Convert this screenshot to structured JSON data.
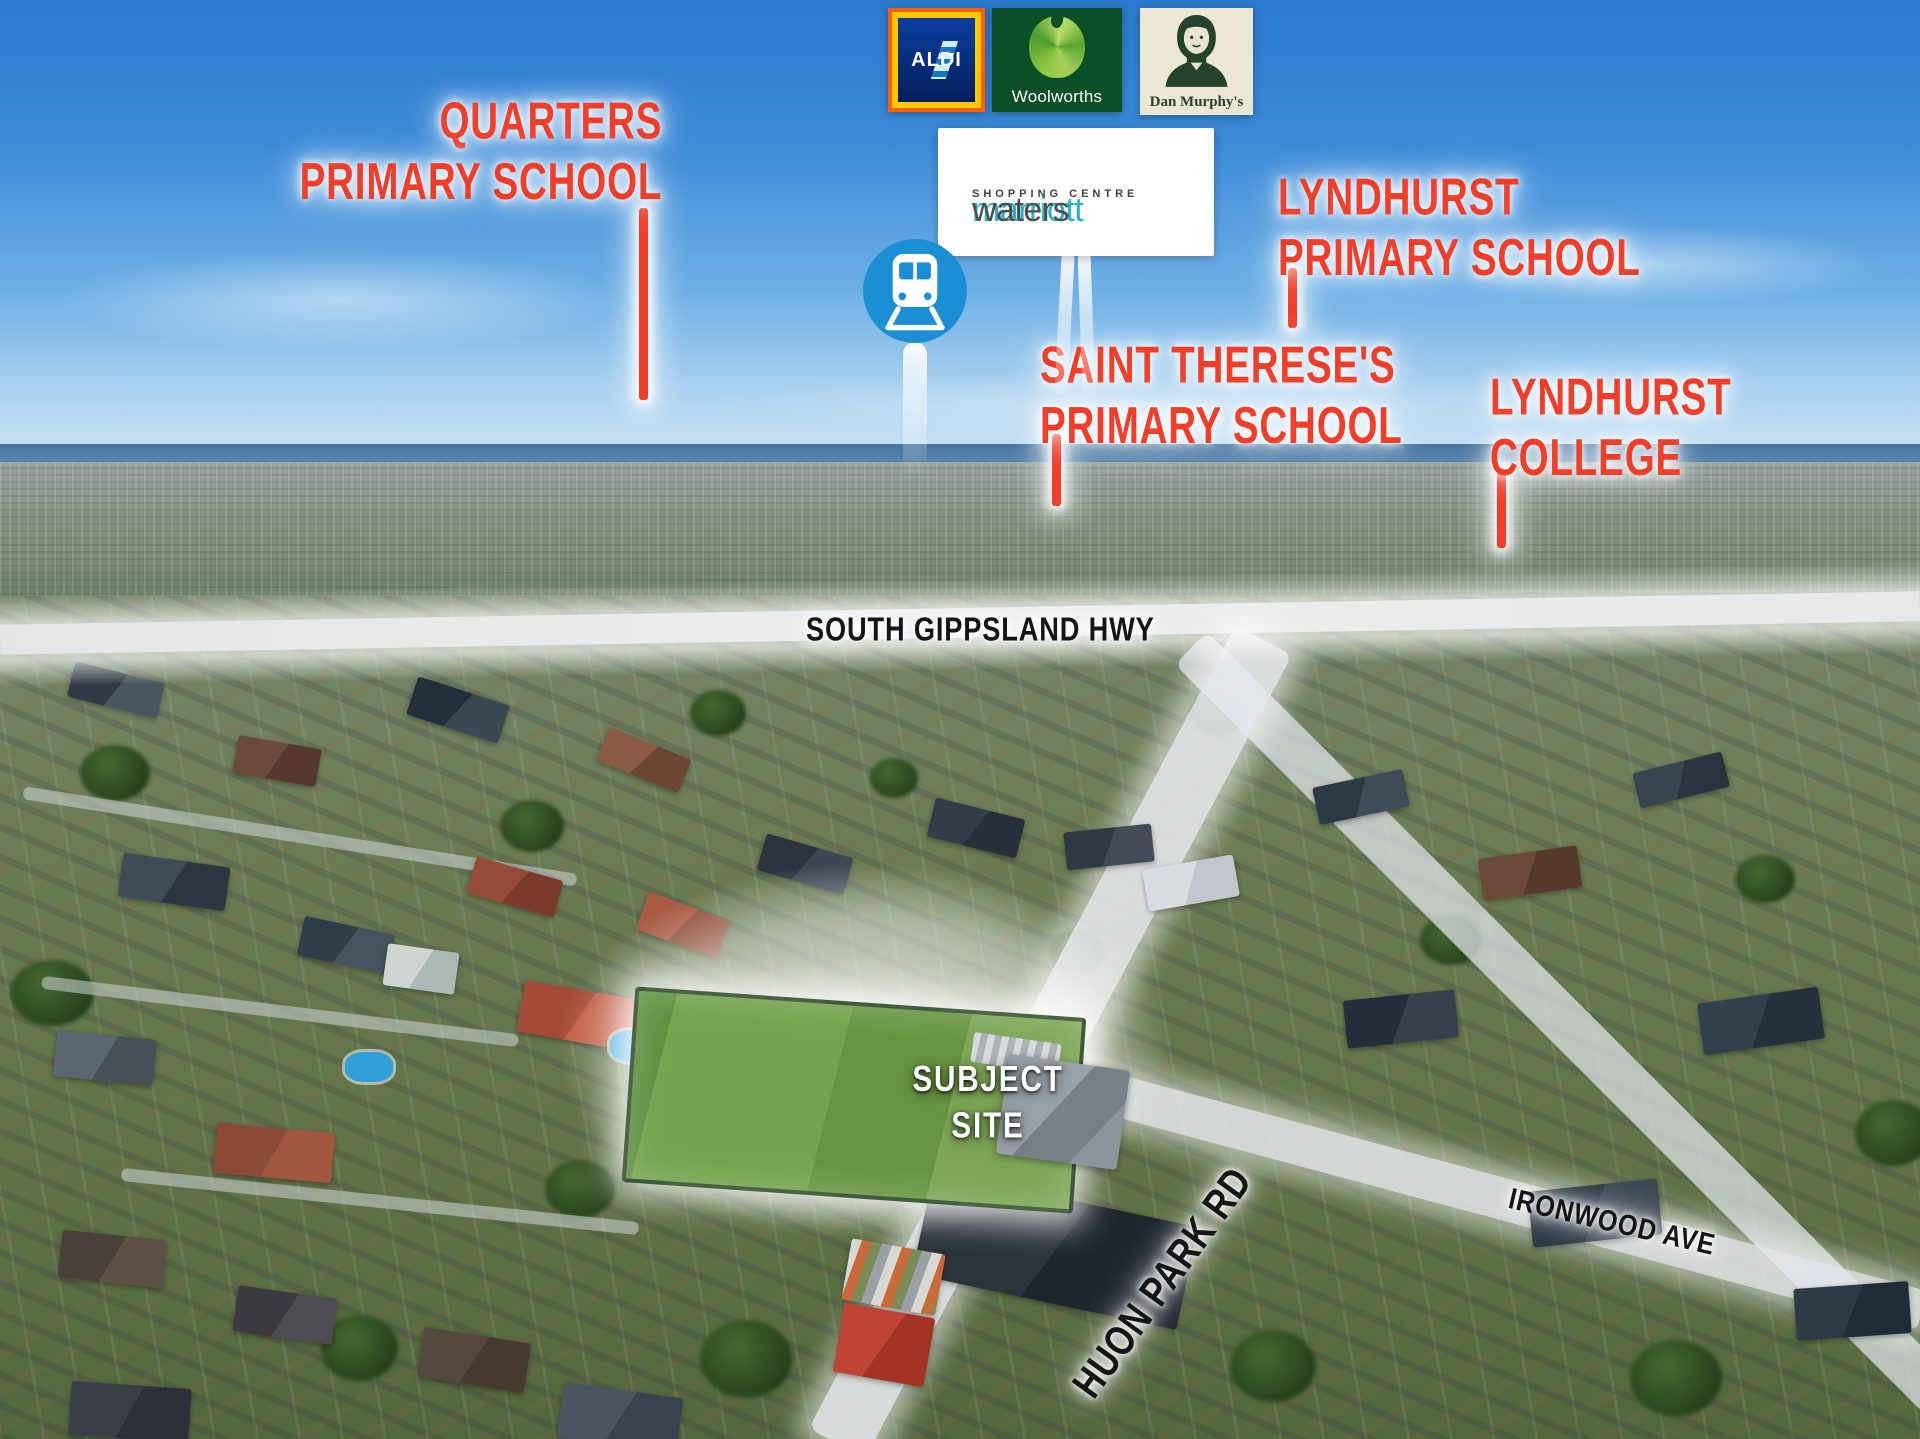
{
  "logos": {
    "aldi": {
      "name": "ALDI"
    },
    "woolworths": {
      "name": "Woolworths"
    },
    "dan_murphys": {
      "name": "Dan Murphy's"
    }
  },
  "shopping_centre": {
    "brand_primary": "marriott",
    "brand_secondary": "waters",
    "tagline": "SHOPPING CENTRE"
  },
  "poi": {
    "quarters": {
      "line1": "QUARTERS",
      "line2": "PRIMARY SCHOOL"
    },
    "lyndhurst_primary": {
      "line1": "LYNDHURST",
      "line2": "PRIMARY SCHOOL"
    },
    "saint_thereses": {
      "line1": "SAINT THERESE'S",
      "line2": "PRIMARY SCHOOL"
    },
    "lyndhurst_college": {
      "line1": "LYNDHURST",
      "line2": "COLLEGE"
    }
  },
  "roads": {
    "highway": "SOUTH GIPPSLAND HWY",
    "huon_park": "HUON PARK RD",
    "ironwood": "IRONWOOD AVE"
  },
  "subject_site": {
    "line1": "SUBJECT",
    "line2": "SITE"
  },
  "icons": {
    "train": "train-station-icon",
    "aldi": "aldi-logo",
    "woolworths": "woolworths-logo",
    "dan_murphys": "dan-murphys-logo"
  },
  "colors": {
    "label_red": "#f23d29",
    "road_text": "#151515",
    "train_blue": "#1c8ed3",
    "aldi_blue": "#062c7a",
    "woolworths_green": "#0b4f27",
    "dan_murphys_green": "#24432c",
    "marriott_teal": "#2ab3c6",
    "marriott_gray": "#4c4c4c"
  }
}
